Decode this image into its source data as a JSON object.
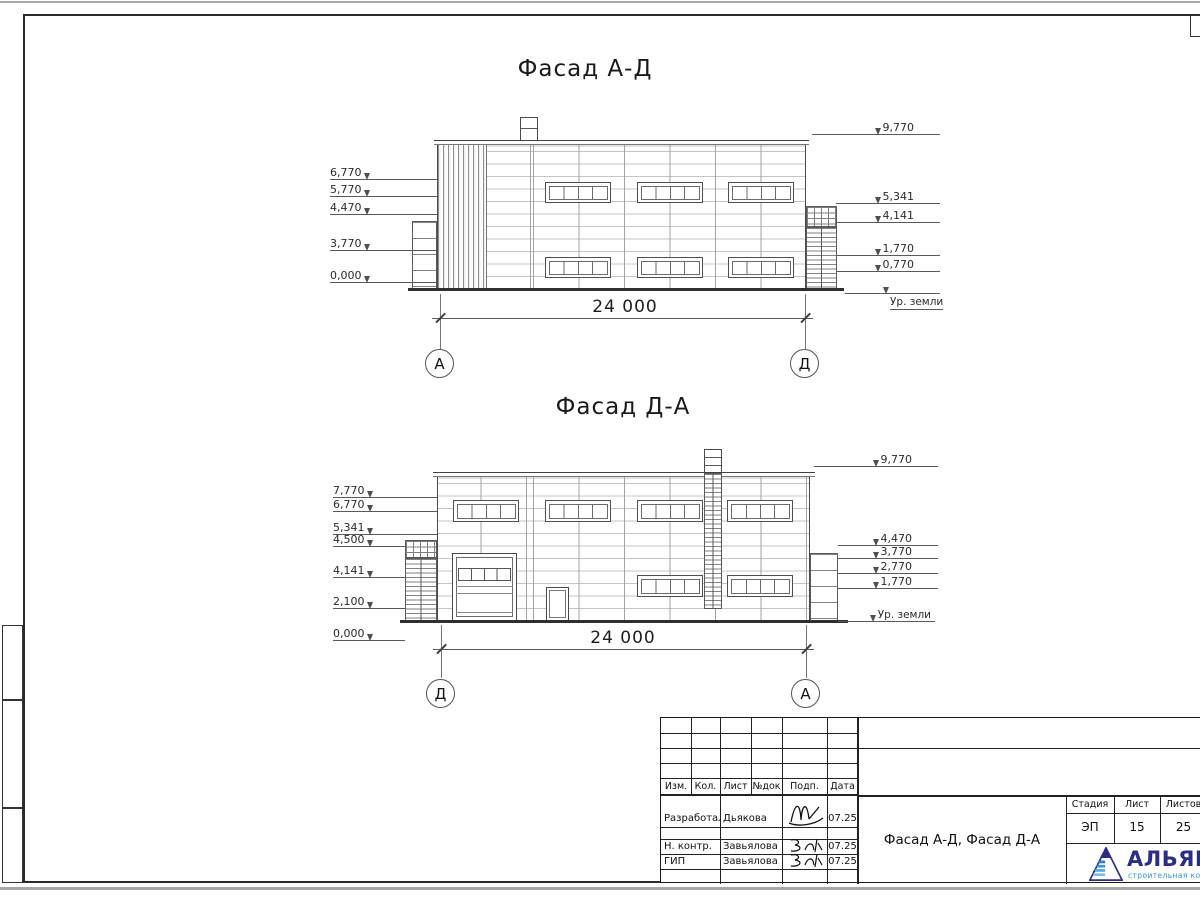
{
  "drawing": {
    "facade1": {
      "title": "Фасад А-Д",
      "left_marks": [
        "6,770",
        "5,770",
        "4,470",
        "3,770",
        "0,000"
      ],
      "right_marks": [
        "9,770",
        "5,341",
        "4,141",
        "1,770",
        "0,770"
      ],
      "ground": "Ур. земли",
      "dim": "24 000",
      "axis_left": "А",
      "axis_right": "Д"
    },
    "facade2": {
      "title": "Фасад Д-А",
      "left_marks": [
        "7,770",
        "6,770",
        "5,341",
        "4,500",
        "4,141",
        "2,100",
        "0,000"
      ],
      "right_marks": [
        "9,770",
        "4,470",
        "3,770",
        "2,770",
        "1,770"
      ],
      "ground": "Ур. земли",
      "dim": "24 000",
      "axis_left": "Д",
      "axis_right": "А"
    }
  },
  "title_block": {
    "cols": [
      "Изм.",
      "Кол.",
      "Лист",
      "№док",
      "Подп.",
      "Дата"
    ],
    "rows": [
      {
        "role": "Разработал",
        "name": "Дьякова",
        "date": "07.25"
      },
      {
        "role": "Н. контр.",
        "name": "Завьялова",
        "date": "07.25"
      },
      {
        "role": "ГИП",
        "name": "Завьялова",
        "date": "07.25"
      }
    ],
    "doc_title": "Фасад А-Д, Фасад Д-А",
    "stage_label": "Стадия",
    "sheet_label": "Лист",
    "sheets_label": "Листов",
    "stage": "ЭП",
    "sheet": "15",
    "sheets": "25",
    "company": "АЛЬЯНС",
    "company_sub": "строительная компания",
    "brand_navy": "#2b2f84",
    "brand_blue": "#2d9ad3"
  }
}
